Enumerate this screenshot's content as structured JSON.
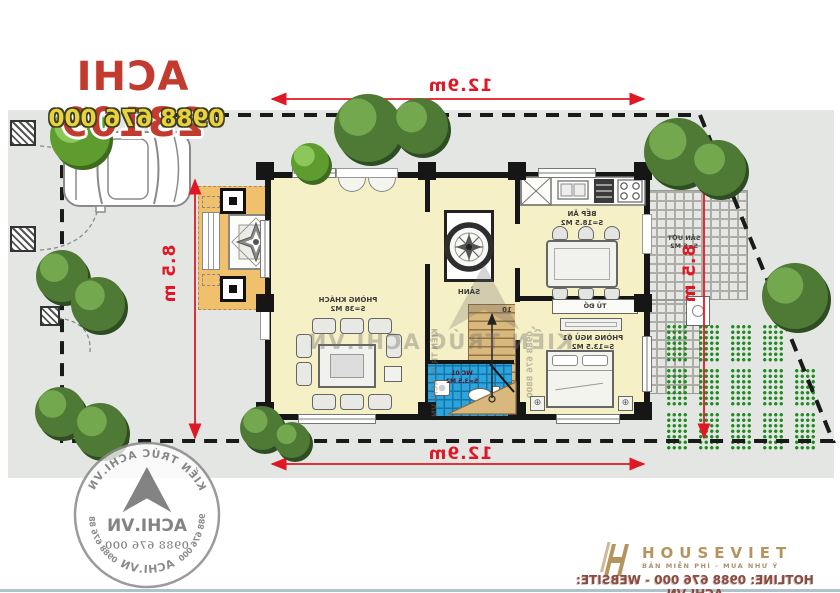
{
  "header": {
    "title": "ACHI 23109",
    "phone": "0988 676 000"
  },
  "dimensions": {
    "top": "12.9m",
    "bottom": "12.9m",
    "left": "8.5 m",
    "right": "8.5 m"
  },
  "rooms": {
    "living": {
      "name": "PHÒNG KHÁCH",
      "area": "S=38 M2"
    },
    "hall": {
      "name": "SẢNH"
    },
    "kitchen": {
      "name": "BẾP ĂN",
      "area": "S=18.5 M2"
    },
    "bedroom": {
      "name": "PHÒNG NGỦ 01",
      "area": "S=13.5 M2"
    },
    "wardrobe": {
      "name": "TỦ ĐỒ"
    },
    "wc": {
      "name": "WC 01",
      "area": "S=3.5 M2"
    },
    "wet_yard": {
      "name": "SÂN ƯỚT",
      "area": "S=6 M2"
    },
    "stair_steps": "10"
  },
  "watermark": {
    "brand": "KIẾN TRÚC ACHI.VN",
    "phone": "0988 676 8800"
  },
  "stamp": {
    "ring_top": "KIẾN TRÚC ACHI.VN",
    "ring_bottom": "ACHI.VN",
    "ring_left": "0988 676 000",
    "ring_right": "0988 676 8800",
    "center_name": "ACHI.VN",
    "center_phone": "0988 676 000"
  },
  "footer": {
    "brand": "HOUSEVIET",
    "tagline": "BẢN MIỄN PHÍ - MUA NHƯ Ý",
    "hotline": "HOTLINE: 0988 676 000 - WEBSITE: ACHI.VN"
  },
  "colors": {
    "dimension_red": "#E01825",
    "title_red": "#C23B2E",
    "phone_yellow": "#E8D23F",
    "floor_cream": "#F6F0C6",
    "porch_orange": "#F0C06C",
    "wc_blue": "#2FA3DB",
    "stair_tan": "#D9B87D",
    "garden_green": "#1E8C1E",
    "brand_gold": "#B5955F"
  }
}
